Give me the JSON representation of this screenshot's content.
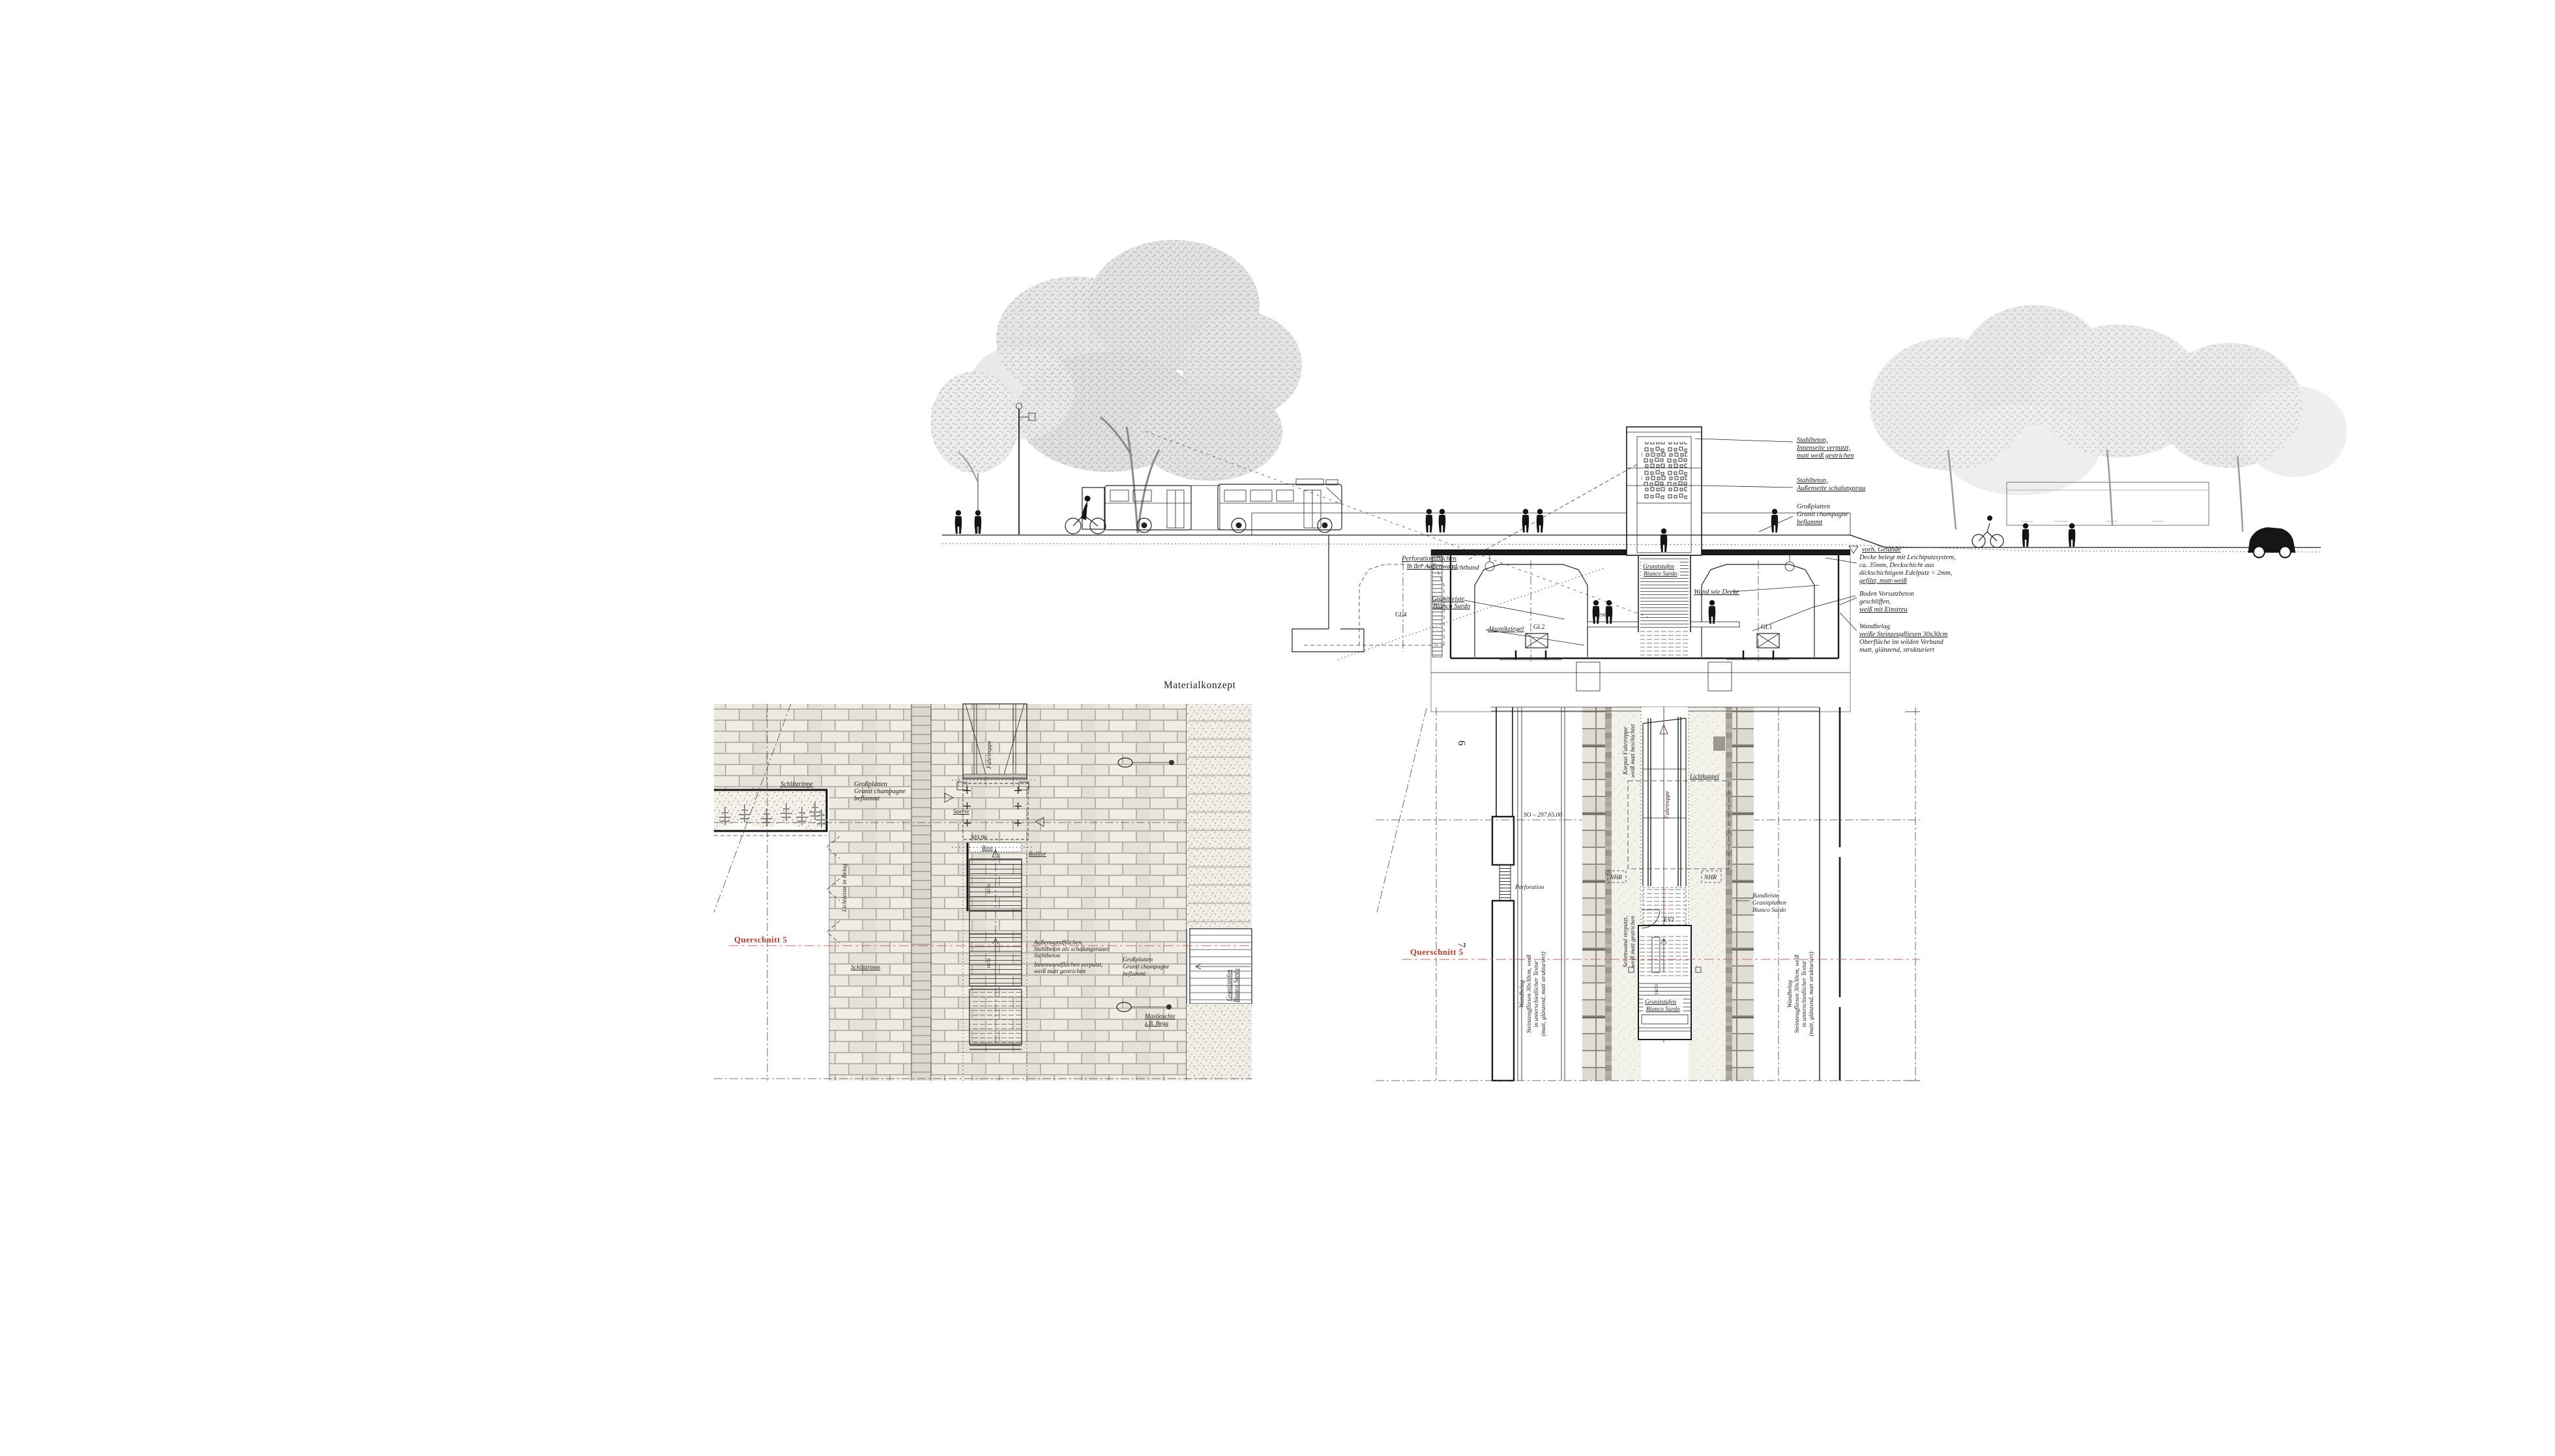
{
  "title": "Materialkonzept",
  "colors": {
    "accent_red": "#bf3a2c",
    "paper": "#ffffff",
    "stone": "#e9e7df"
  },
  "shared": {
    "querschnitt": "Querschnitt 5",
    "grossplatten": [
      "Großplatten",
      "Granit champagne",
      "beflammt"
    ],
    "granitstufen": [
      "Granitstufen",
      "Bianco Sardo"
    ],
    "schlitzrinne": "Schlitzrinne",
    "fahrtreppe": "Fahrtreppe",
    "step_dim": "16/31"
  },
  "section": {
    "annotations": {
      "stahlbeton_innen": [
        "Stahlbeton,",
        "Innenseite verputzt,",
        "matt weiß gestrichen"
      ],
      "stahlbeton_aussen": [
        "Stahlbeton,",
        "Außenseite schalungsrau"
      ],
      "decke": [
        "Decke belegt mit Leichtputzsystem,",
        "ca. 35mm, Deckschicht aus",
        "dickschichtigem Edelputz < 2mm,",
        "gefilzt, matt-weiß"
      ],
      "boden": [
        "Boden Vorsatzbeton",
        "geschliffen,",
        "weiß mit Einstreu"
      ],
      "wandbelag": [
        "Wandbelag",
        "weiße Steinzeugfliesen 30x30cm",
        "Oberfläche im wilden Verband",
        "matt, glänzend, strukturiert"
      ]
    },
    "labels": {
      "perforation": [
        "Perforationsflächen",
        "in der Außenwand"
      ],
      "granitleiste": [
        "Granitleiste",
        "Bianco Sardo"
      ],
      "gl4": "Gl.4",
      "gl2": "Gl.2",
      "gl1": "Gl.1",
      "akustikziegel": "Akustikziegel",
      "lichtband": "Lichtband",
      "wand_wie_decke": "Wand wie Decke",
      "vorh_gelaende": "vorh. Gelände",
      "platform_elevation": "298.65"
    }
  },
  "left_plan": {
    "sperre": "Sperre",
    "elevation": "303,96",
    "rost": "Rost",
    "rolltor": "Rolltor",
    "lichtleiste": "Lichtleiste in Belag",
    "aussenwand": [
      "Außenwandflächen",
      "Stahlbeton als schalungsrauer",
      "Sichtbeton"
    ],
    "innenwand": [
      "Innenwandflächen verputzt,",
      "weiß matt gestrichen"
    ],
    "mastleuchte": [
      "Mastleuchte",
      "z.B. Bega"
    ]
  },
  "right_plan": {
    "axis_6": "6",
    "axis_7": "7",
    "so_level": "SO – 297,65.00",
    "perforation": "Perforation",
    "korpus": [
      "Korpus Fahrtreppe",
      "weiß matt beschichtet"
    ],
    "lichtkuppel": "Lichtkuppel",
    "nhr": "NHR",
    "ev": "EV1",
    "seitenwand": [
      "Seitenwand verputzt,",
      "weiß matt gestrichen"
    ],
    "randleiste": [
      "Randleiste",
      "Granitplatten",
      "Bianco Sardo"
    ],
    "wandbelag": [
      "Wandbelag",
      "Steinzeugfliesen 30x30cm, weiß",
      "in unterschiedlicher Textur",
      "(matt, glänzend, matt strukturiert)"
    ]
  }
}
